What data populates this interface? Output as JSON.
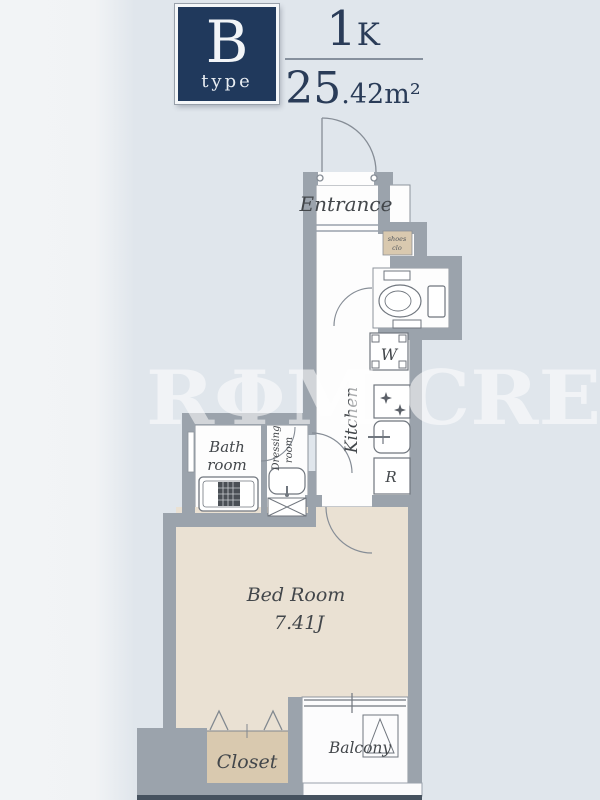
{
  "header": {
    "type_letter": "B",
    "type_word": "type",
    "layout_main": "1",
    "layout_sub": "K",
    "area_main": "25",
    "area_frac": ".42",
    "area_unit": "m²"
  },
  "watermark": {
    "text": "RΦM CRE"
  },
  "rooms": {
    "entrance": "Entrance",
    "shoes_closet_line1": "shoes",
    "shoes_closet_line2": "clo",
    "kitchen": "Kitchen",
    "washer": "W",
    "fridge": "R",
    "bath_line1": "Bath",
    "bath_line2": "room",
    "dressing_line1": "Dressing",
    "dressing_line2": "room",
    "bedroom_name": "Bed Room",
    "bedroom_size": "7.41J",
    "closet": "Closet",
    "balcony": "Balcony"
  },
  "colors": {
    "accent_navy": "#20395c",
    "wall_gray": "#9ba3ac",
    "bedroom_floor": "#eae1d3",
    "closet_floor": "#d9c9af",
    "background": "#e0e6ec",
    "fixture_line": "#70767e",
    "label_text": "#43474b",
    "watermark_white": "#ffffff"
  }
}
